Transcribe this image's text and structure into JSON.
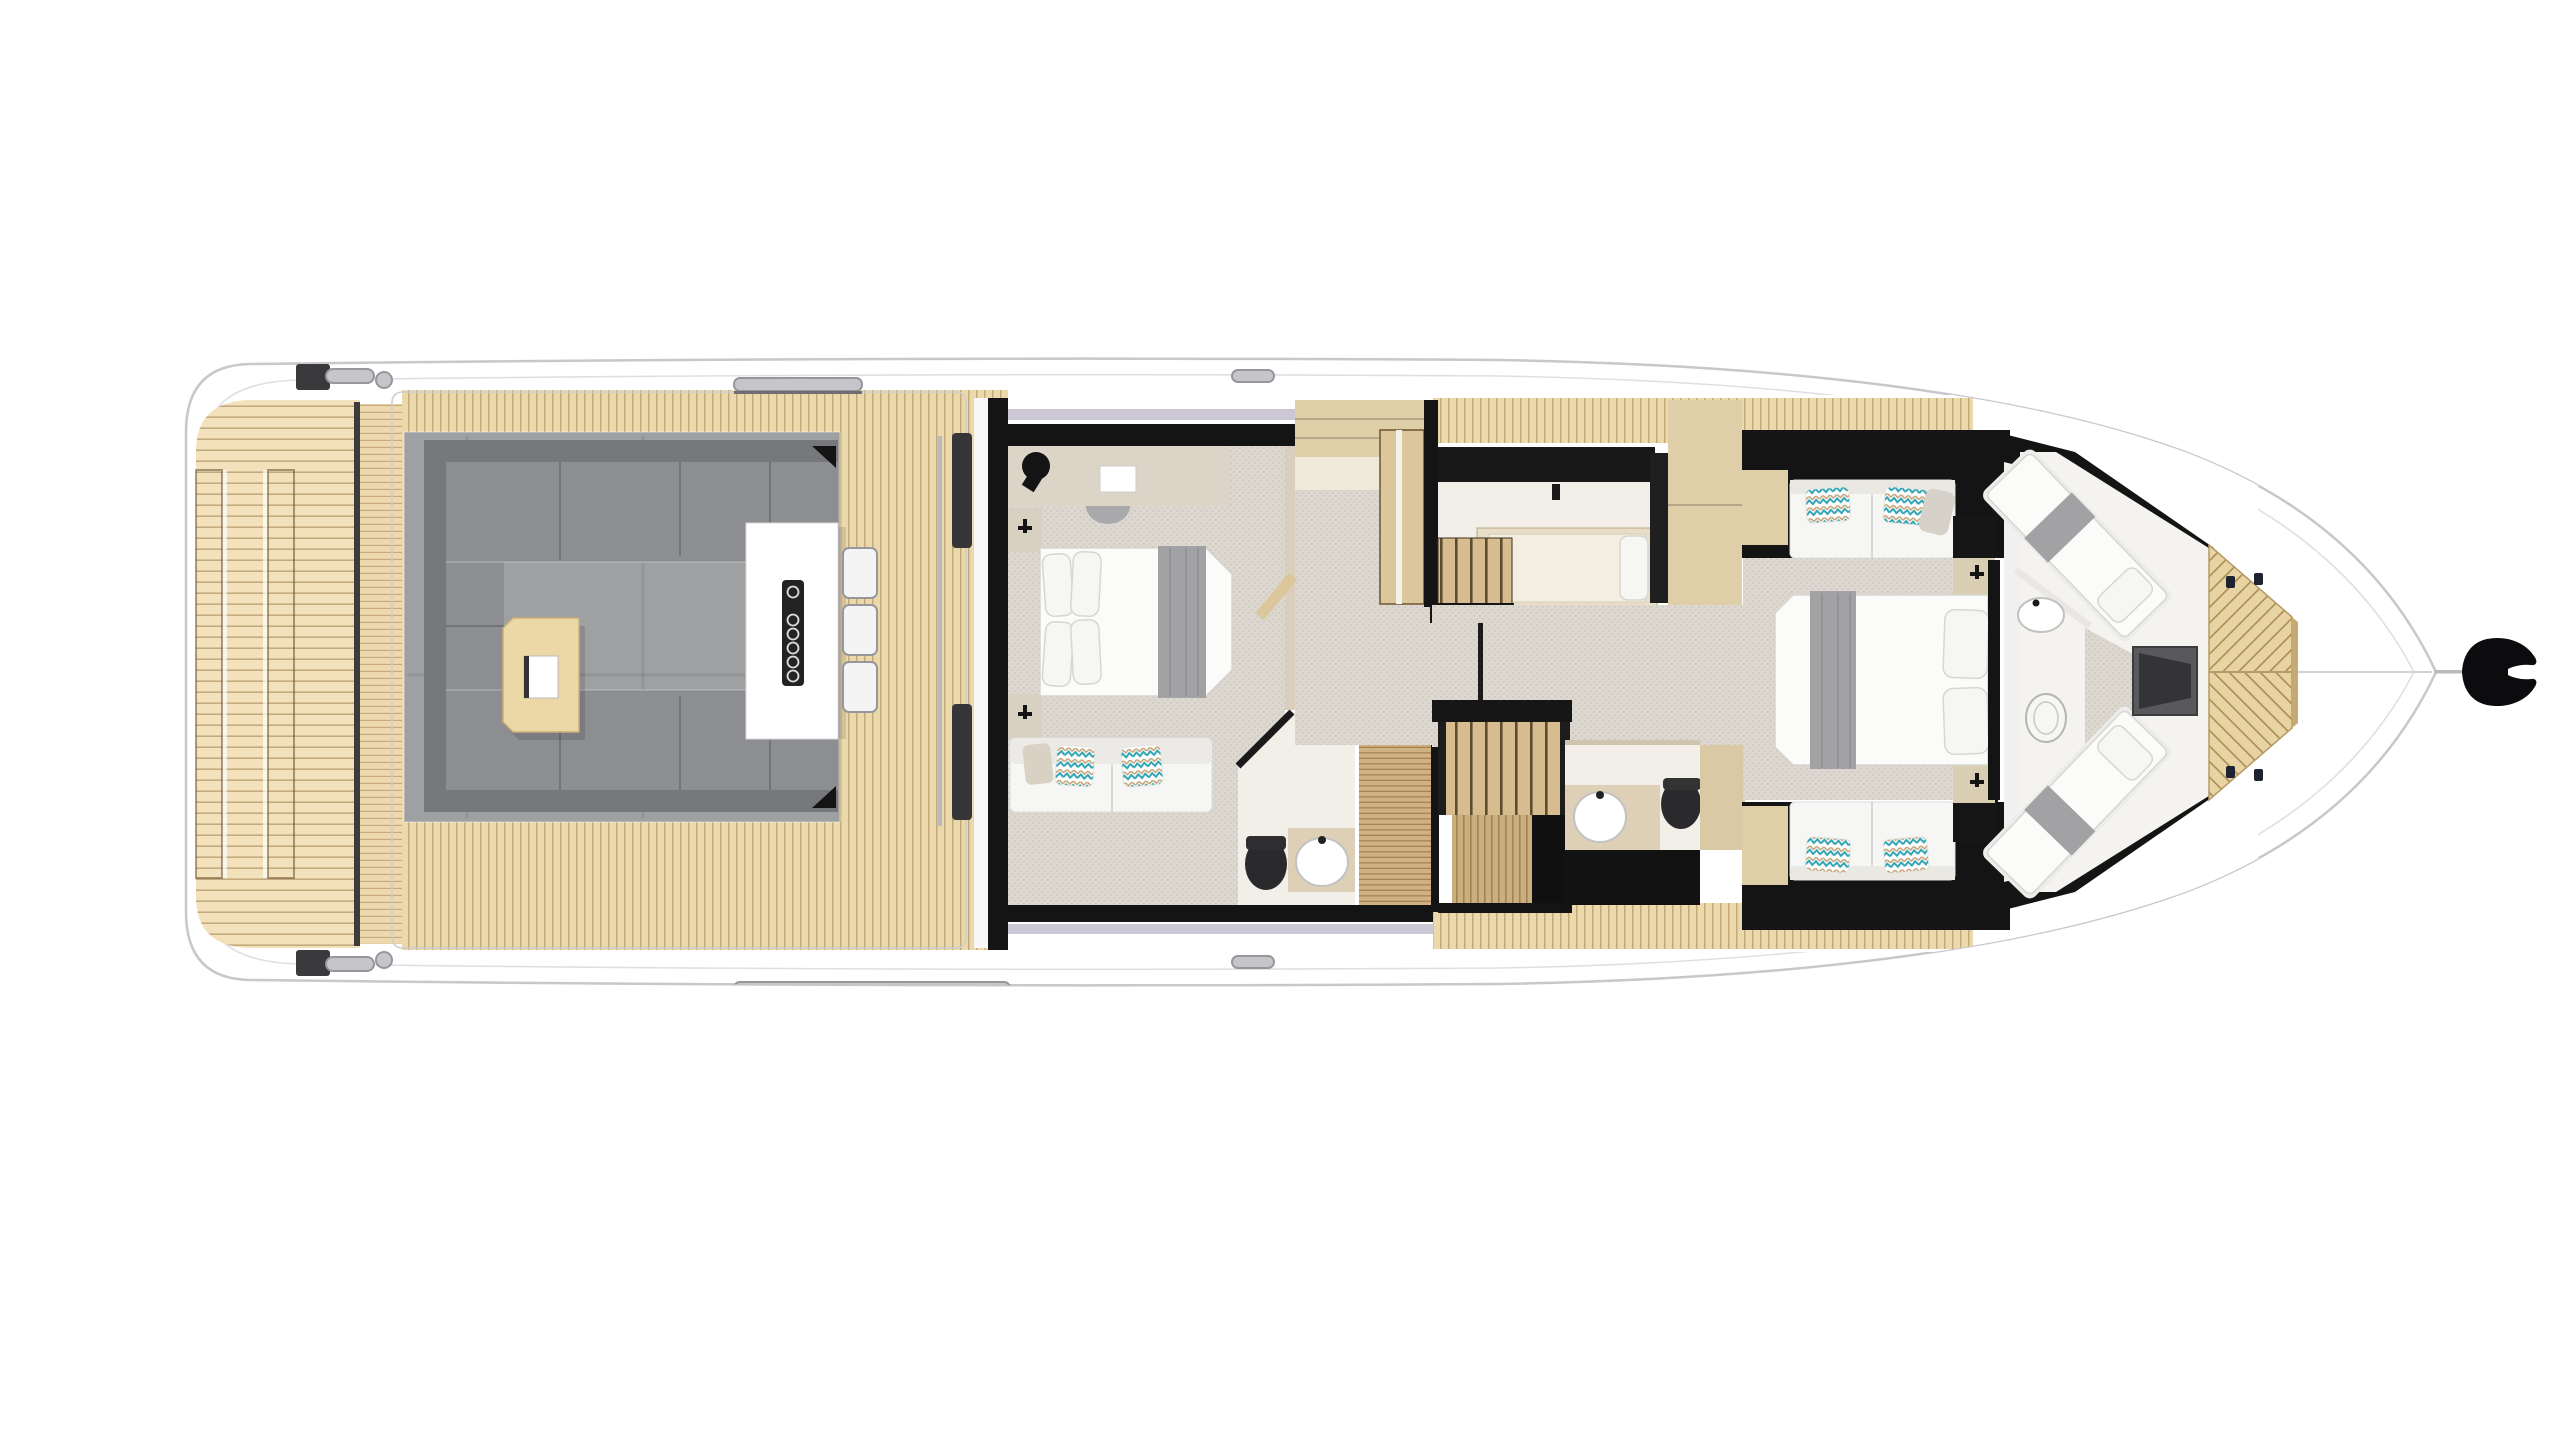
{
  "meta": {
    "title": "Motor yacht top-down floor plan",
    "type": "floor-plan",
    "view": "overhead",
    "orientation": "bow-right"
  },
  "palette": {
    "hull_outline": "#c7c7cc",
    "hull_inner_line": "#e0e0e4",
    "wood_platform": "#f2e1ba",
    "wood_step": "#eed9af",
    "wood_deck": "#ebd8ab",
    "wood_line": "#8a6531",
    "teak_floor": "#cfb184",
    "stair_tread": "#d6bc8e",
    "stair_slat": "#c9ae80",
    "foredeck_wood": "#e8d3a2",
    "carpet_base": "#dcd8d0",
    "carpet_dot": "#8d877b",
    "lounge_floor": "#9fa0a2",
    "lounge_back": "#77787b",
    "lounge_cushion": "#8d8e91",
    "table_wood": "#ecd7a6",
    "bar_counter": "#ffffff",
    "speaker_panel": "#232323",
    "stool_seat": "#f4f4f4",
    "chrome": "#c6c6ca",
    "chrome_edge": "#97979b",
    "bulkhead_black": "#141414",
    "window_frame": "#ccc7d5",
    "room_floor": "#f2efe9",
    "counter_beige": "#ddd0b6",
    "cabinet_beige": "#dfcfa8",
    "bed_white": "#fbfbfa",
    "bed_outline": "#d7d6d2",
    "pillow_white": "#f6f6f4",
    "runner_gray": "#a2a2a5",
    "sofa_white": "#f6f6f4",
    "toilet_dark": "#2a2a2d",
    "sink_white": "#ffffff",
    "hatch_gray": "#59595c",
    "anchor_black": "#0c0c0e",
    "bench_beige": "#dfd0ae",
    "door_wood": "#dcc69c",
    "chevron_teal": "#2ea4b4",
    "chevron_tan": "#c49f72",
    "accent_pillow_gray": "#d6d2c9"
  },
  "sections": {
    "stern": {
      "swim_platform": "teak swim platform with horizontal planking",
      "hatch_rails": 2,
      "cleats": 2
    },
    "cockpit": {
      "lounge_sofa": "U-shaped gray lounge sofa",
      "coffee_table": "wood coffee table with serving tray",
      "wet_bar": "white wet-bar counter",
      "speaker_holes": 6,
      "bar_stools": 3,
      "corner_brackets": 2,
      "cleats": 2
    },
    "salon_door": "sliding glass door with twin dark handles",
    "master_cabin": {
      "bed": "double bed, gray foot runner",
      "pillows": 4,
      "sofa": "two-seat white sofa",
      "accent_pillows": 3,
      "vanity": "dresser with stool and tray",
      "wall_lamps": 2,
      "ensuite": {
        "sink": 1,
        "toilet": 1,
        "shower": "teak-grate floor"
      }
    },
    "midship": {
      "wardrobe_cabinets": 3,
      "stairs_up": "companionway from cockpit",
      "stairs_down": "stair to lower landing",
      "twin_cabin": {
        "bed": 1,
        "bench": 1
      },
      "day_head": {
        "sink": 1,
        "toilet": 1
      }
    },
    "vip_cabin": {
      "bed": "double bed facing aft, gray runner",
      "pillows": 2,
      "sofas": 2,
      "accent_pillows": 4,
      "nightstands": 2,
      "wardrobes": 2
    },
    "bow_cabin": {
      "v_berths": 2,
      "sink": 1,
      "toilet": 1,
      "deck_hatch": 1
    },
    "foredeck": {
      "planking": "mirrored diagonal teak",
      "cleats": 4
    },
    "anchor": "anchor-icon at bow tip"
  }
}
